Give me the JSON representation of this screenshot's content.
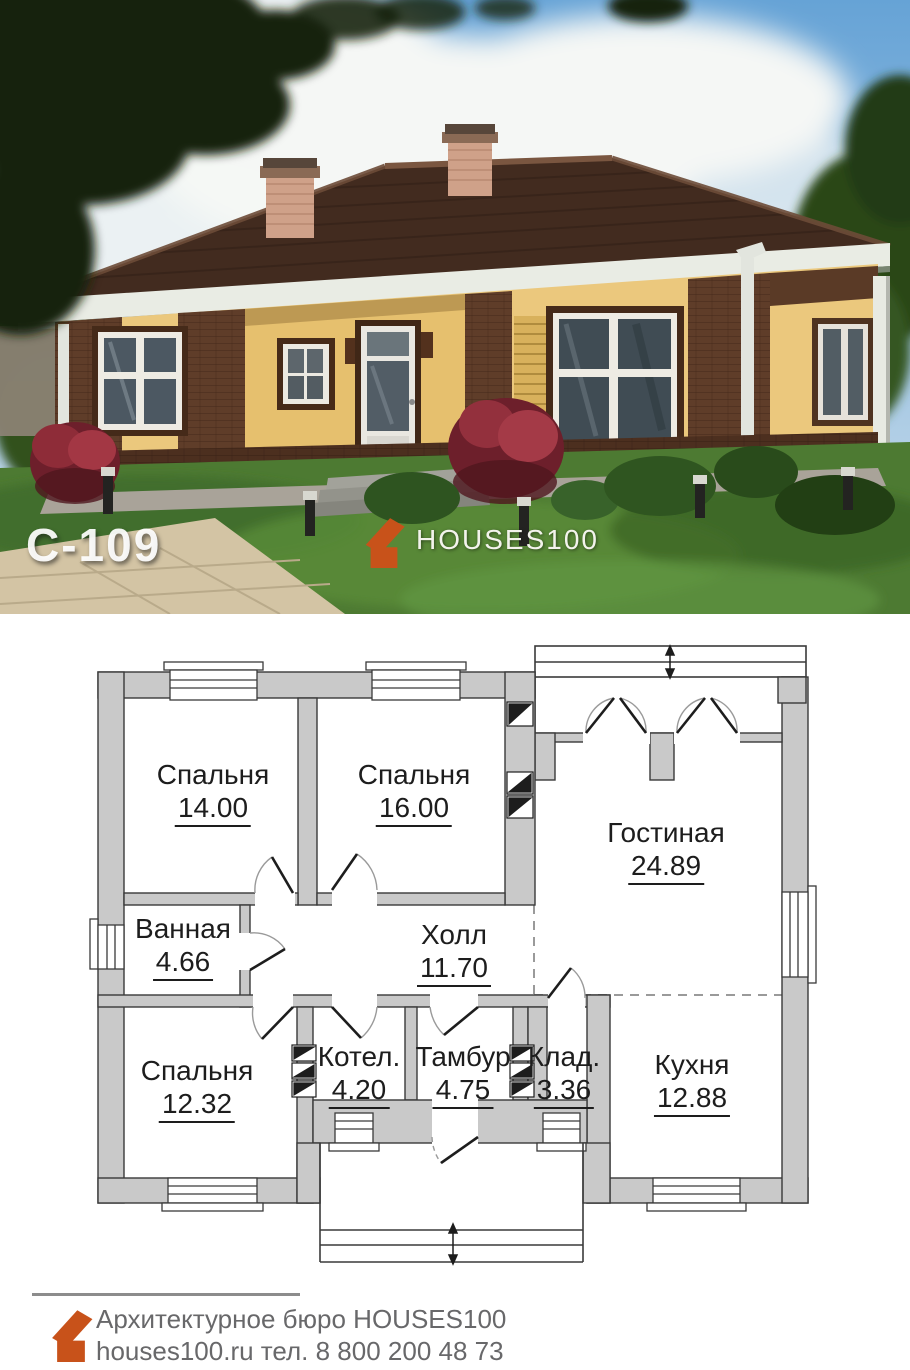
{
  "photo": {
    "plan_code": "С-109",
    "brand_name": "HOUSES100"
  },
  "plan": {
    "rooms": [
      {
        "id": "bedroom-1",
        "name": "Спальня",
        "area": "14.00"
      },
      {
        "id": "bedroom-2",
        "name": "Спальня",
        "area": "16.00"
      },
      {
        "id": "living-room",
        "name": "Гостиная",
        "area": "24.89"
      },
      {
        "id": "bathroom",
        "name": "Ванная",
        "area": "4.66"
      },
      {
        "id": "hall",
        "name": "Холл",
        "area": "11.70"
      },
      {
        "id": "bedroom-3",
        "name": "Спальня",
        "area": "12.32"
      },
      {
        "id": "boiler-room",
        "name": "Котел.",
        "area": "4.20"
      },
      {
        "id": "vestibule",
        "name": "Тамбур",
        "area": "4.75"
      },
      {
        "id": "storage",
        "name": "Клад.",
        "area": "3.36"
      },
      {
        "id": "kitchen",
        "name": "Кухня",
        "area": "12.88"
      }
    ]
  },
  "footer": {
    "company": "Архитектурное бюро HOUSES100",
    "website_phone": "houses100.ru  тел. 8 800 200 48 73"
  },
  "colors": {
    "brand_orange": "#c8521a",
    "plan_wall_fill": "#c9c9c9",
    "plan_line": "#3a3a3a"
  }
}
